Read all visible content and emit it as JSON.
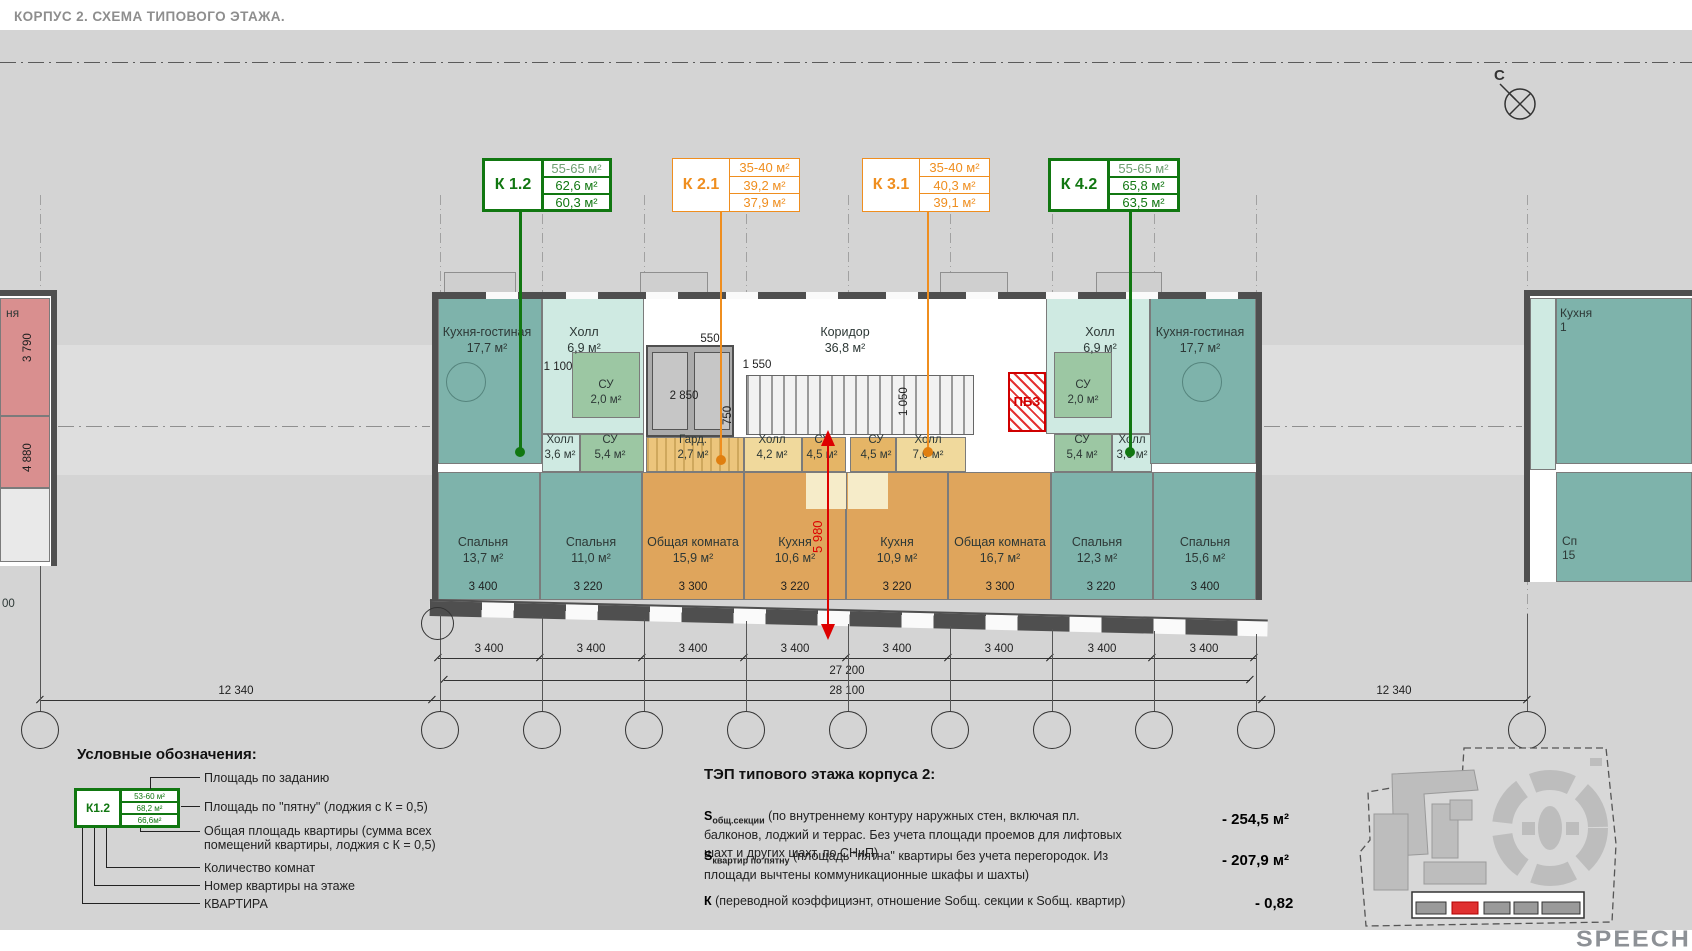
{
  "title": "КОРПУС 2. СХЕМА ТИПОВОГО ЭТАЖА.",
  "north_label": "С",
  "logo": "SPEECH",
  "tags": [
    {
      "id": "К 1.2",
      "rows": [
        "55-65 м²",
        "62,6 м²",
        "60,3 м²"
      ]
    },
    {
      "id": "К 2.1",
      "rows": [
        "35-40 м²",
        "39,2 м²",
        "37,9 м²"
      ]
    },
    {
      "id": "К 3.1",
      "rows": [
        "35-40 м²",
        "40,3 м²",
        "39,1 м²"
      ]
    },
    {
      "id": "К 4.2",
      "rows": [
        "55-65 м²",
        "65,8 м²",
        "63,5 м²"
      ]
    }
  ],
  "plan": {
    "rooms": [
      {
        "name": "Кухня-гостиная",
        "area": "17,7 м²"
      },
      {
        "name": "Холл",
        "area": "6,9 м²"
      },
      {
        "name": "Коридор",
        "area": "36,8 м²"
      },
      {
        "name": "Холл",
        "area": "6,9 м²"
      },
      {
        "name": "Кухня-гостиная",
        "area": "17,7 м²"
      },
      {
        "name": "СУ",
        "area": "2,0 м²"
      },
      {
        "name": "Холл",
        "area": "3,6 м²"
      },
      {
        "name": "СУ",
        "area": "5,4 м²"
      },
      {
        "name": "Гард.",
        "area": "2,7 м²"
      },
      {
        "name": "Холл",
        "area": "4,2 м²"
      },
      {
        "name": "СУ",
        "area": "4,5 м²"
      },
      {
        "name": "СУ",
        "area": "4,5 м²"
      },
      {
        "name": "Холл",
        "area": "7,0 м²"
      },
      {
        "name": "СУ",
        "area": "5,4 м²"
      },
      {
        "name": "Холл",
        "area": "3,6 м²"
      },
      {
        "name": "СУ",
        "area": "2,0 м²"
      },
      {
        "name": "ПБЗ",
        "area": ""
      },
      {
        "name": "Спальня",
        "area": "13,7 м²"
      },
      {
        "name": "Спальня",
        "area": "11,0 м²"
      },
      {
        "name": "Общая комната",
        "area": "15,9 м²"
      },
      {
        "name": "Кухня",
        "area": "10,6 м²"
      },
      {
        "name": "Кухня",
        "area": "10,9 м²"
      },
      {
        "name": "Общая комната",
        "area": "16,7 м²"
      },
      {
        "name": "Спальня",
        "area": "12,3 м²"
      },
      {
        "name": "Спальня",
        "area": "15,6 м²"
      }
    ],
    "partial_left": {
      "room": "ня",
      "v1": "3 790",
      "v2": "4 880",
      "cut": "00"
    },
    "partial_right": {
      "kitchen_name": "Кухня",
      "kitchen_area": "1",
      "bedroom_name": "Сп",
      "bedroom_area": "15"
    }
  },
  "dims": {
    "room_widths": [
      "3 400",
      "3 220",
      "3 300",
      "3 220",
      "3 220",
      "3 300",
      "3 220",
      "3 400"
    ],
    "bays": [
      "3 400",
      "3 400",
      "3 400",
      "3 400",
      "3 400",
      "3 400",
      "3 400",
      "3 400"
    ],
    "total_inner": "27 200",
    "total_outer": "28 100",
    "left_gap": "12 340",
    "right_gap": "12 340",
    "hall_door": "1 100",
    "door": "550",
    "lift": "2 850",
    "lift_depth": "750",
    "stair_w": "1 550",
    "stair_gap": "1 050",
    "section": "5 980"
  },
  "legend": {
    "heading": "Условные обозначения:",
    "sample": {
      "id": "К1.2",
      "rows": [
        "53-60 м²",
        "68,2 м²",
        "66,6м²"
      ]
    },
    "items": [
      "Площадь по заданию",
      "Площадь по \"пятну\" (лоджия с К = 0,5)",
      "Общая площадь квартиры (сумма всех помещений квартиры, лоджия с К = 0,5)",
      "Количество комнат",
      "Номер квартиры на этаже",
      "КВАРТИРА"
    ]
  },
  "tep": {
    "heading": "ТЭП типового этажа корпуса 2:",
    "rows": [
      {
        "sym": "S",
        "sub": "общ.секции",
        "text": "(по внутреннему контуру наружных стен, включая пл. балконов, лоджий и террас. Без учета площади проемов для лифтовых шахт и других шахт, по СНиП)",
        "value": "- 254,5 м²"
      },
      {
        "sym": "S",
        "sub": "квартир по пятну",
        "text": "(площадь \"пятна\" квартиры без учета перегородок. Из площади вычтены коммуникационные шкафы и шахты)",
        "value": "- 207,9 м²"
      },
      {
        "sym": "К",
        "sub": "",
        "text": "(переводной коэффициэнт, отношение Sобщ. секции к Sобщ. квартир)",
        "value": "- 0,82"
      }
    ]
  }
}
